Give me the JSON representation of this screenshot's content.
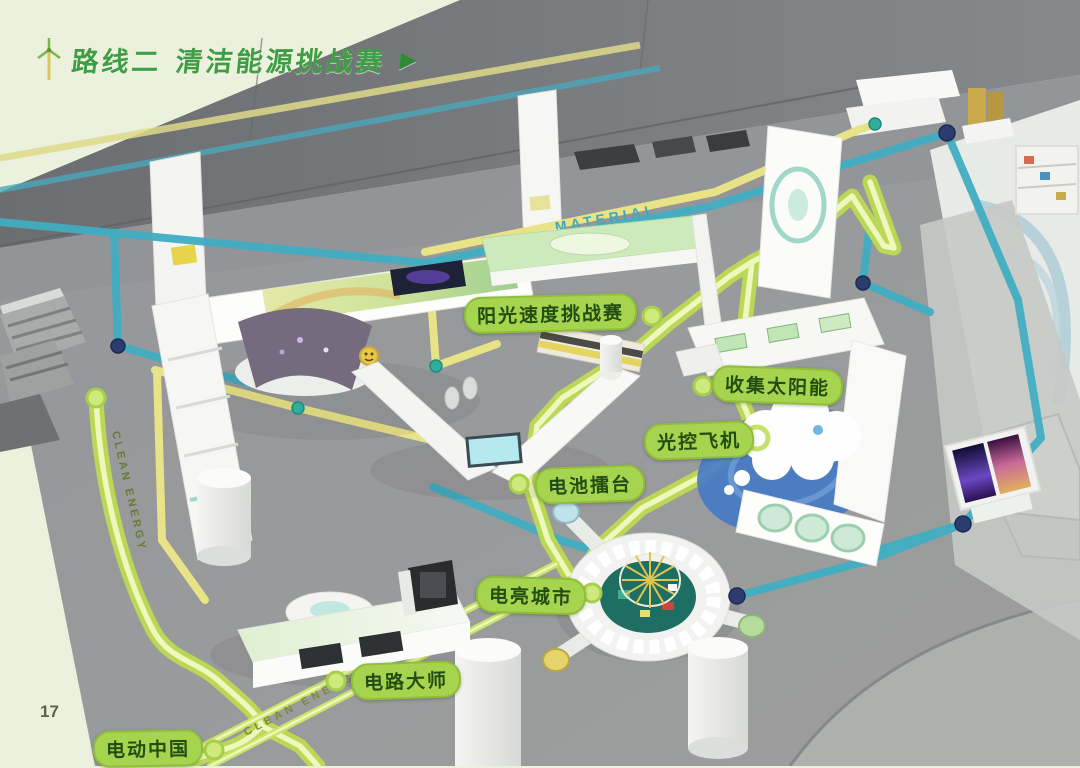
{
  "page": {
    "number": "17"
  },
  "header": {
    "route_label": "路线二",
    "title": "清洁能源挑战赛",
    "arrow": "▶",
    "icon": "wind-turbine-icon"
  },
  "stations": [
    {
      "label": "阳光速度挑战赛"
    },
    {
      "label": "收集太阳能"
    },
    {
      "label": "光控飞机"
    },
    {
      "label": "电池擂台"
    },
    {
      "label": "电亮城市"
    },
    {
      "label": "电路大师"
    },
    {
      "label": "电动中国"
    }
  ],
  "floor_texts": {
    "material": "MATERIAL",
    "clean_energy": "CLEAN ENERGY"
  },
  "colors": {
    "title_green": "#3f9e44",
    "route_highlight": "#c3e060",
    "route_core": "#eef7bc",
    "path_teal": "#41aec2",
    "path_yellow": "#e9e387",
    "station_pill": "#a6d44e",
    "station_dot": "#cfe97c",
    "junction_dot": "#2c3c6e",
    "floor_gray": "#98999b",
    "background_green": "#ecf1dd"
  }
}
